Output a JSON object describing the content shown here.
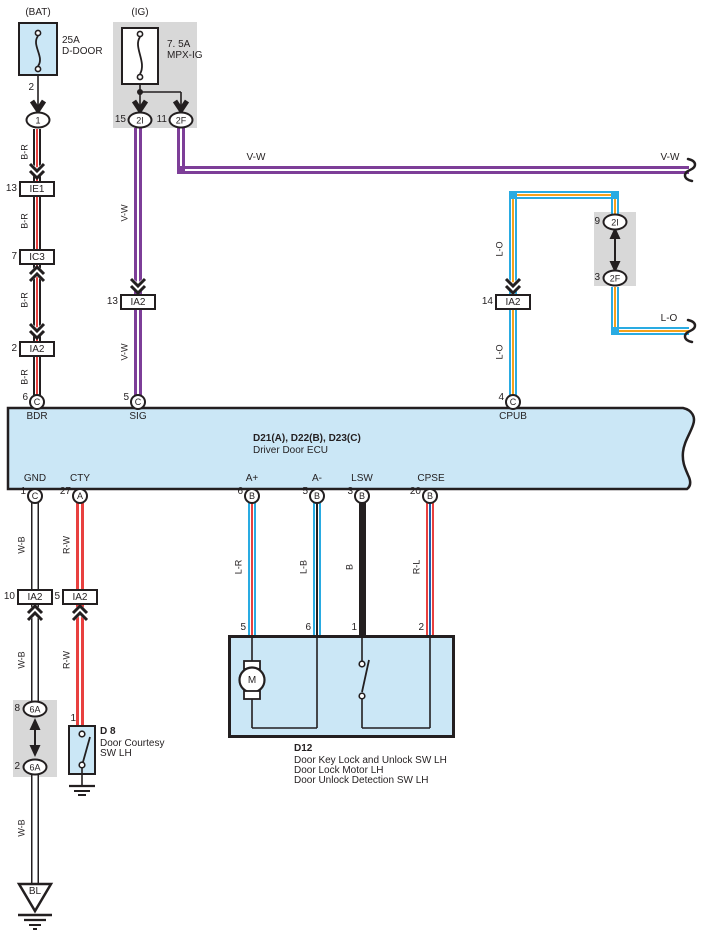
{
  "colors": {
    "panel_fill": "#cbe7f6",
    "gray_fill": "#d8d8d8",
    "line": "#231f20",
    "red": "#e8403f",
    "violet": "#7d3e98",
    "cyan": "#29abe2",
    "orange": "#f5a21b",
    "blue": "#1f5fae"
  },
  "power": {
    "bat": {
      "title": "(BAT)",
      "rating": "25A",
      "fuse_name": "D-DOOR",
      "out_pin": "2",
      "connector": "1"
    },
    "ig": {
      "title": "(IG)",
      "rating": "7. 5A",
      "fuse_name": "MPX-IG",
      "branch_left": {
        "pin": "15",
        "connector": "2I"
      },
      "branch_right": {
        "pin": "11",
        "connector": "2F"
      }
    }
  },
  "wire_labels": {
    "b_r": "B-R",
    "v_w": "V-W",
    "l_o": "L-O",
    "w_b": "W-B",
    "r_w": "R-W",
    "l_r": "L-R",
    "l_b": "L-B",
    "b": "B",
    "r_l": "R-L"
  },
  "connectors": {
    "ie1": {
      "pin": "13",
      "name": "IE1"
    },
    "ic3": {
      "pin": "7",
      "name": "IC3"
    },
    "ia2_bdr": {
      "pin": "2",
      "name": "IA2"
    },
    "ia2_sig": {
      "pin": "13",
      "name": "IA2"
    },
    "ia2_cpub": {
      "pin": "14",
      "name": "IA2"
    },
    "ia2_gnd": {
      "pin": "10",
      "name": "IA2"
    },
    "ia2_cty": {
      "pin": "5",
      "name": "IA2"
    }
  },
  "jumper_right": {
    "top_pin": "9",
    "top_connector": "2I",
    "bottom_pin": "3",
    "bottom_connector": "2F"
  },
  "jumper_left": {
    "top_pin": "8",
    "top_connector": "6A",
    "bottom_pin": "2",
    "bottom_connector": "6A"
  },
  "ecu": {
    "code_line": "D21(A), D22(B), D23(C)",
    "name_line": "Driver Door ECU",
    "pins_top": [
      {
        "pin": "6",
        "code": "C",
        "label": "BDR"
      },
      {
        "pin": "5",
        "code": "C",
        "label": "SIG"
      },
      {
        "pin": "4",
        "code": "C",
        "label": "CPUB"
      }
    ],
    "pins_bottom": [
      {
        "pin": "1",
        "code": "C",
        "label": "GND"
      },
      {
        "pin": "27",
        "code": "A",
        "label": "CTY"
      },
      {
        "pin": "6",
        "code": "B",
        "label": "A+"
      },
      {
        "pin": "5",
        "code": "B",
        "label": "A-"
      },
      {
        "pin": "3",
        "code": "B",
        "label": "LSW"
      },
      {
        "pin": "20",
        "code": "B",
        "label": "CPSE"
      }
    ]
  },
  "d8": {
    "pin": "1",
    "id": "D 8",
    "desc_1": "Door Courtesy",
    "desc_2": "SW LH"
  },
  "d12": {
    "id": "D12",
    "pin_motor_a": "5",
    "pin_motor_b": "6",
    "pin_sw_a": "1",
    "pin_sw_b": "2",
    "motor_label": "M",
    "desc_1": "Door Key Lock and Unlock SW LH",
    "desc_2": "Door Lock Motor LH",
    "desc_3": "Door Unlock Detection SW LH"
  },
  "ground_connector": "BL"
}
